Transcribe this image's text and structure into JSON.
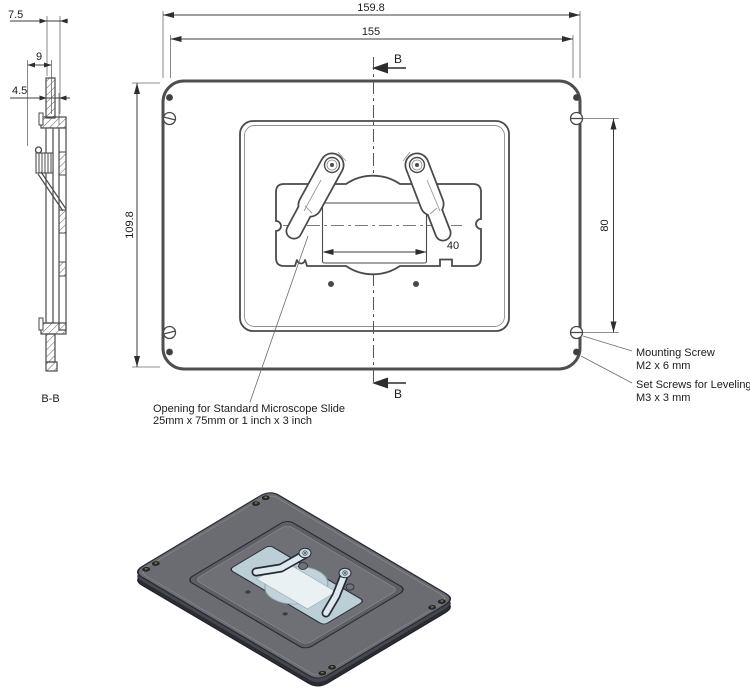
{
  "top_view": {
    "dim_outer_width": "159.8",
    "dim_inner_width": "155",
    "dim_height": "109.8",
    "dim_screw_span": "80",
    "dim_aperture_width": "40",
    "section_arrow_label_top": "B",
    "section_arrow_label_bottom": "B",
    "opening_note_line1": "Opening for Standard Microscope Slide",
    "opening_note_line2": "25mm x 75mm or 1 inch x 3 inch",
    "mounting_screw_line1": "Mounting Screw",
    "mounting_screw_line2": "M2 x 6 mm",
    "set_screw_line1": "Set Screws for Leveling",
    "set_screw_line2": "M3 x 3 mm"
  },
  "section_view": {
    "label": "B-B",
    "dim_top_overhang": "7.5",
    "dim_bracket_depth": "9",
    "dim_plate_offset": "4.5"
  },
  "colors": {
    "drawing_line": "#4a4a4a",
    "plate_top": "#6a6c72",
    "plate_side": "#2b2d33",
    "recess": "#5d5f66",
    "recess_floor": "#6e7076",
    "holder": "#bccfd6",
    "slide": "#eaf1f3",
    "clamp": "#dce9ee",
    "outline_3d": "#282a32"
  }
}
